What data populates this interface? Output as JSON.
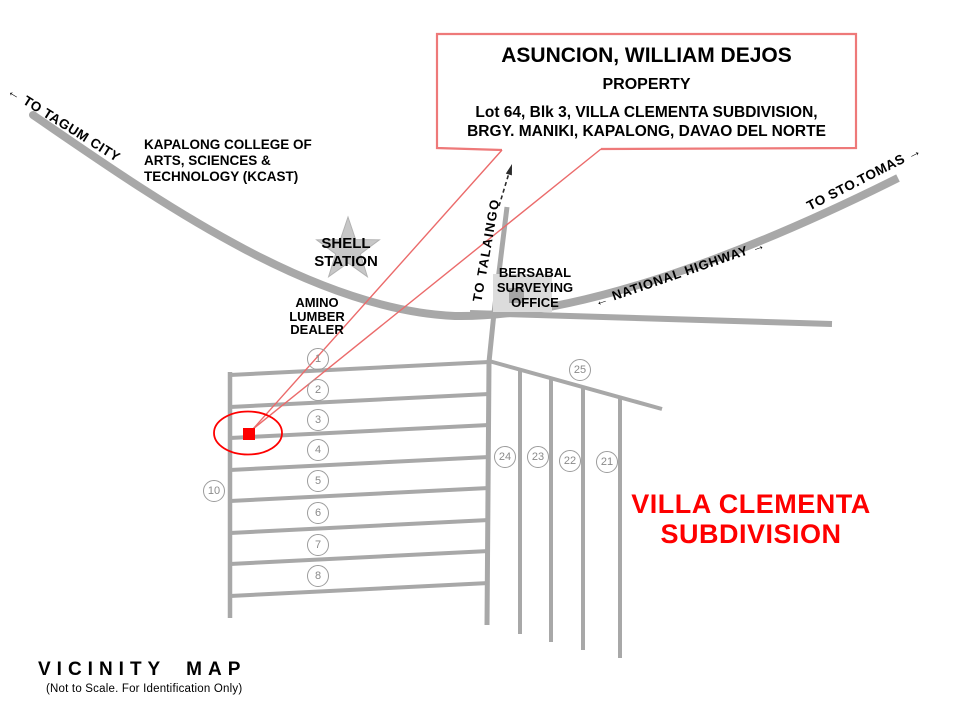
{
  "title_callout": {
    "owner": "ASUNCION, WILLIAM DEJOS",
    "property_label": "PROPERTY",
    "address_line1": "Lot 64, Blk 3, VILLA CLEMENTA SUBDIVISION,",
    "address_line2": "BRGY. MANIKI, KAPALONG, DAVAO DEL NORTE"
  },
  "road_labels": {
    "to_tagum_city": "← TO TAGUM CITY",
    "to_sto_tomas": "TO STO.TOMAS →",
    "national_highway": "← NATIONAL HIGHWAY →",
    "to_talaingo": "TO TALAINGO"
  },
  "landmarks": {
    "kcast": "KAPALONG COLLEGE OF\nARTS, SCIENCES &\nTECHNOLOGY (KCAST)",
    "shell_station": "SHELL\nSTATION",
    "amino_lumber": "AMINO\nLUMBER\nDEALER",
    "bersabal_office": "BERSABAL\nSURVEYING\nOFFICE"
  },
  "subdivision": {
    "name": "VILLA CLEMENTA\nSUBDIVISION"
  },
  "lot_markers": {
    "m1": "1",
    "m2": "2",
    "m3": "3",
    "m4": "4",
    "m5": "5",
    "m6": "6",
    "m7": "7",
    "m8": "8",
    "m10": "10",
    "m21": "21",
    "m22": "22",
    "m23": "23",
    "m24": "24",
    "m25": "25"
  },
  "footer": {
    "title": "VICINITY MAP",
    "note": "(Not to Scale. For Identification Only)"
  },
  "colors": {
    "highlight_red": "#fe0000",
    "callout_border": "#ee7979",
    "leader_red": "#eb6b6b",
    "road_gray": "#a8a8a8",
    "star_gray": "#c7c7c7",
    "building_gray": "#dcdcdc"
  }
}
